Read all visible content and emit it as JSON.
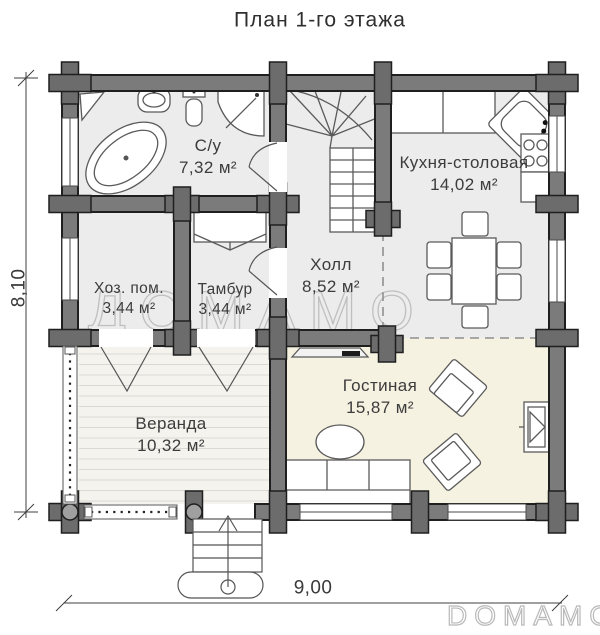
{
  "title": "План 1-го этажа",
  "dimensions": {
    "vertical": "8,10",
    "horizontal": "9,00"
  },
  "watermarks": {
    "center": "ДОМАМО",
    "corner": "DOMAMO"
  },
  "colors": {
    "wall": "#7b7b7b",
    "joint": "#6c6c6c",
    "floor_gray": "#ececec",
    "floor_cream": "#f6f2e2",
    "floor_veranda": "#f4f3ee"
  },
  "rooms": {
    "bathroom": {
      "name": "С/у",
      "area": "7,32 м²"
    },
    "kitchen": {
      "name": "Кухня-столовая",
      "area": "14,02 м²"
    },
    "hall": {
      "name": "Холл",
      "area": "8,52 м²"
    },
    "utility": {
      "name": "Хоз. пом.",
      "area": "3,44 м²"
    },
    "tambour": {
      "name": "Тамбур",
      "area": "3,44 м²"
    },
    "veranda": {
      "name": "Веранда",
      "area": "10,32 м²"
    },
    "living": {
      "name": "Гостиная",
      "area": "15,87 м²"
    }
  }
}
